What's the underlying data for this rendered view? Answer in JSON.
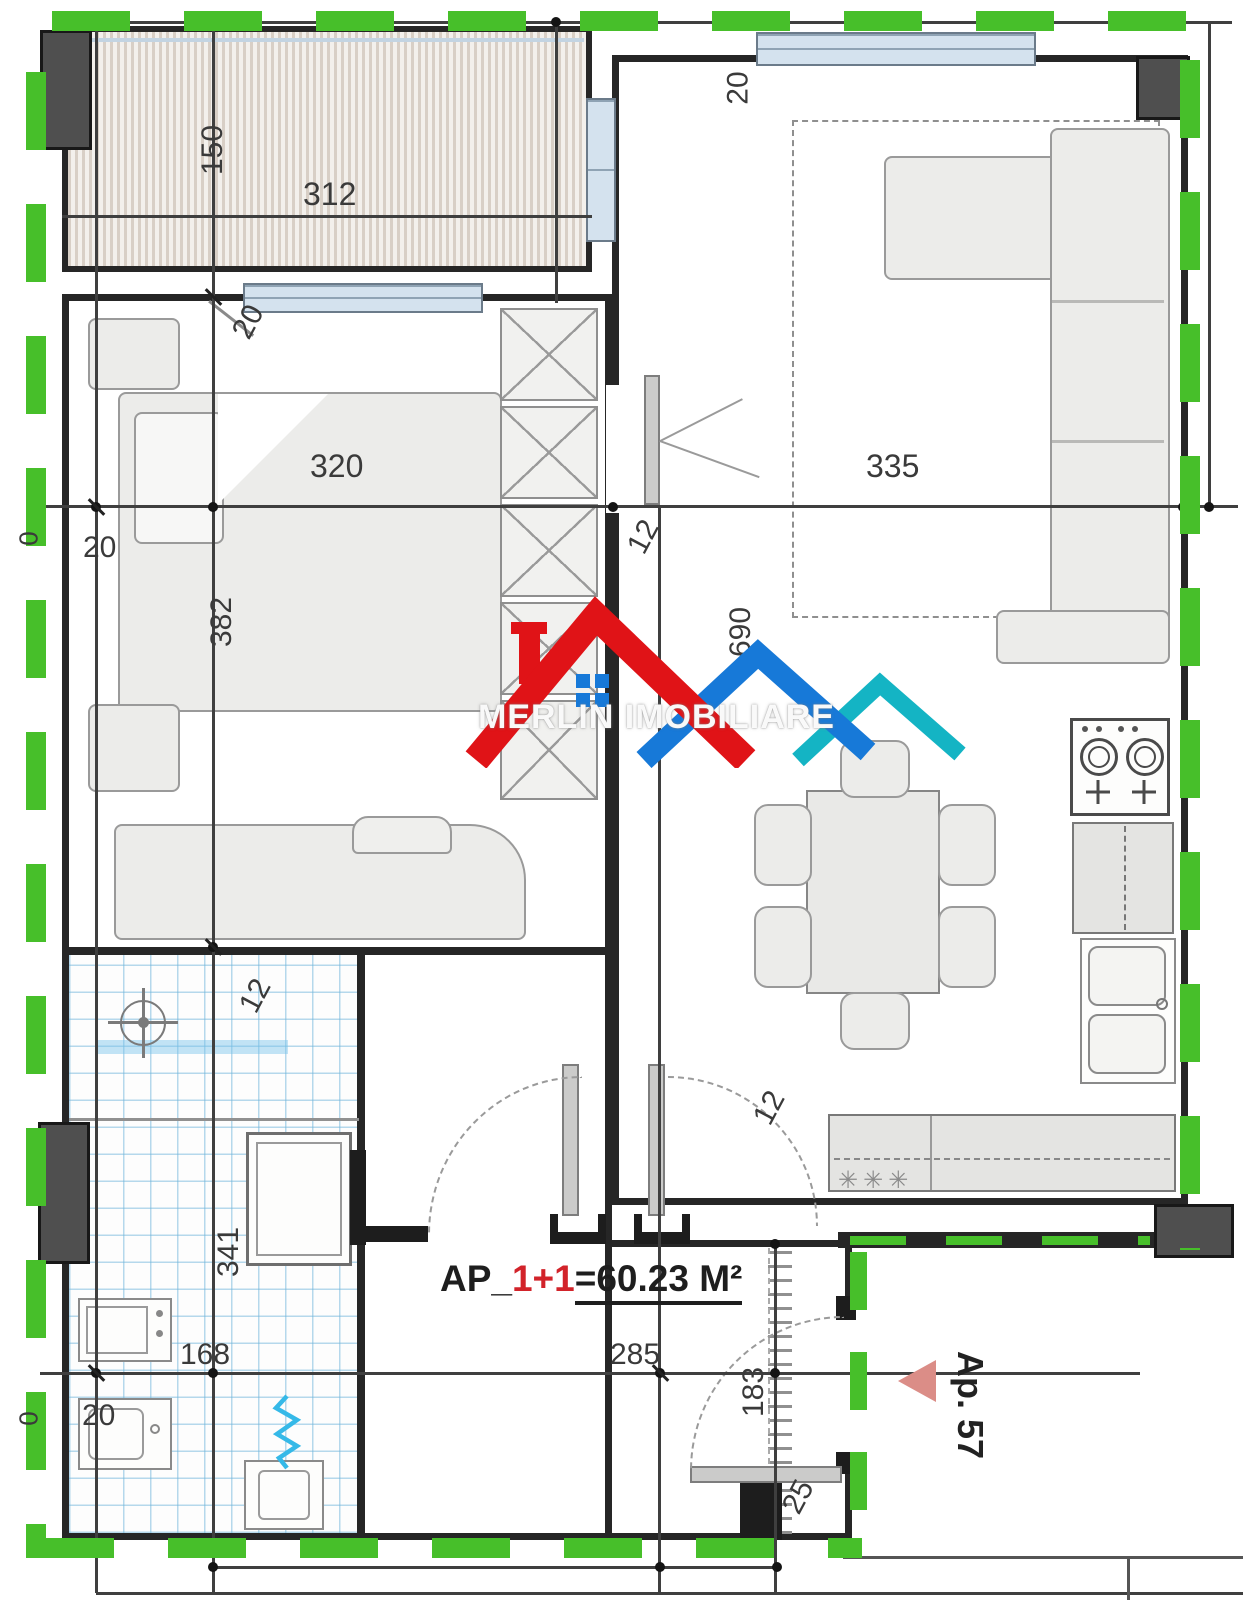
{
  "plan": {
    "watermark_brand": "MERLIN IMOBILIARE",
    "area_label": {
      "prefix": "AP_",
      "unit": "1+1",
      "value": "=60.23 M²"
    },
    "neighbor_label": "Ap. 57",
    "counter_marks": "✳✳✳",
    "colors": {
      "boundary_green": "#47bf2a",
      "wall_black": "#262626",
      "tile_blue": "#78b9dc",
      "hatch_beige": "#d8cfc6",
      "logo_red": "#e01317",
      "logo_blue": "#1779d8",
      "logo_teal": "#14b4c4",
      "area_red": "#d2232a",
      "marker_salmon": "#db8d87"
    },
    "dims": {
      "balcony_depth": "150",
      "balcony_width": "312",
      "balcony_door": "20",
      "living_top": "20",
      "bedroom_width": "320",
      "living_width": "335",
      "hall_gap": "12",
      "hall_depth": "690",
      "bedroom_depth": "382",
      "bedroom_wall": "20",
      "zero_upper": "0",
      "bath_top": "12",
      "bath_depth": "341",
      "kitchen_gap": "12",
      "bath_width": "168",
      "bath_wall": "20",
      "zero_lower": "0",
      "entry_width": "285",
      "entry_depth": "183",
      "entry_jamb": "25"
    }
  }
}
